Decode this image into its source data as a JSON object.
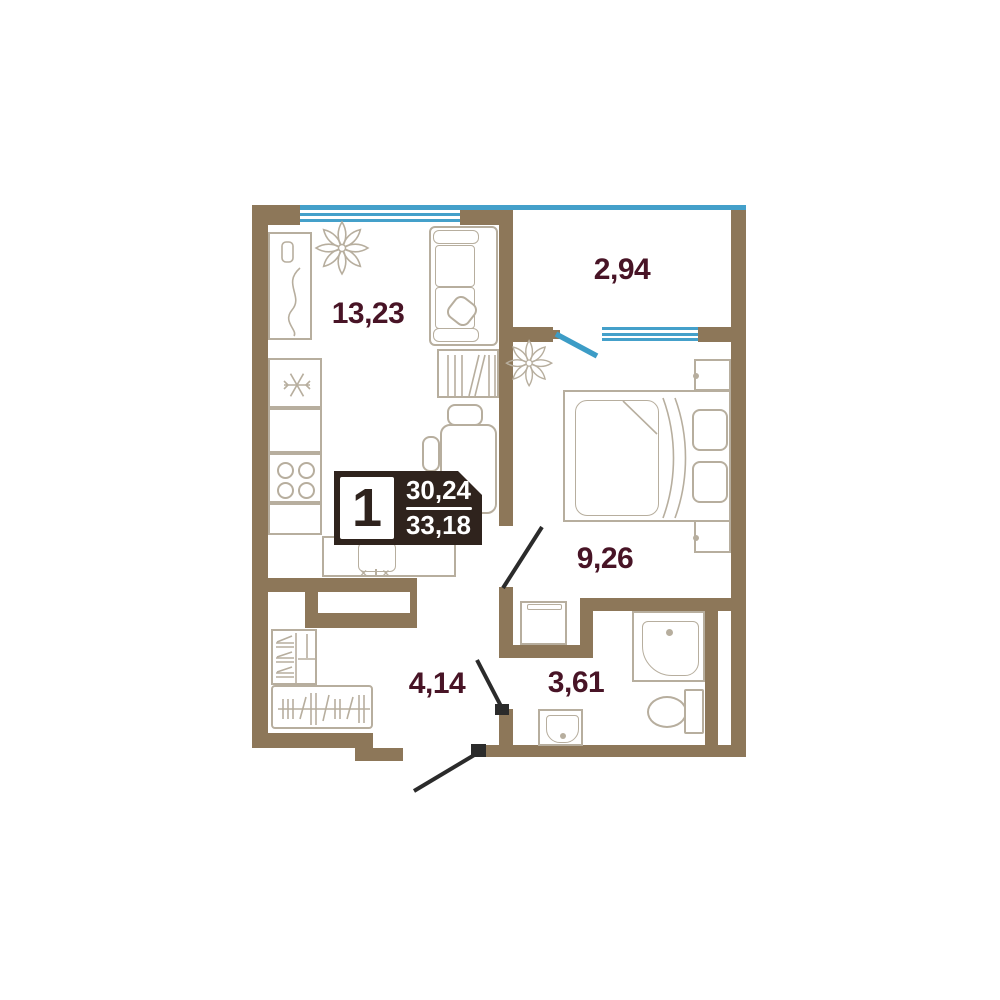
{
  "plan": {
    "badge": {
      "rooms_count": "1",
      "area_living": "30,24",
      "area_total": "33,18"
    },
    "rooms": [
      {
        "name": "living-kitchen",
        "area": "13,23"
      },
      {
        "name": "balcony",
        "area": "2,94"
      },
      {
        "name": "bedroom",
        "area": "9,26"
      },
      {
        "name": "hallway",
        "area": "4,14"
      },
      {
        "name": "bathroom",
        "area": "3,61"
      }
    ],
    "icons": {
      "plant": "✻",
      "snowflake": "❄",
      "faucet_handles": "× ×"
    },
    "colors": {
      "wall": "#8d7759",
      "furniture_outline": "#b7ae9e",
      "glazing": "#44a0ca",
      "door_leaf": "#2b2b2b",
      "room_label": "#481426",
      "badge_background": "#2f231d"
    }
  }
}
